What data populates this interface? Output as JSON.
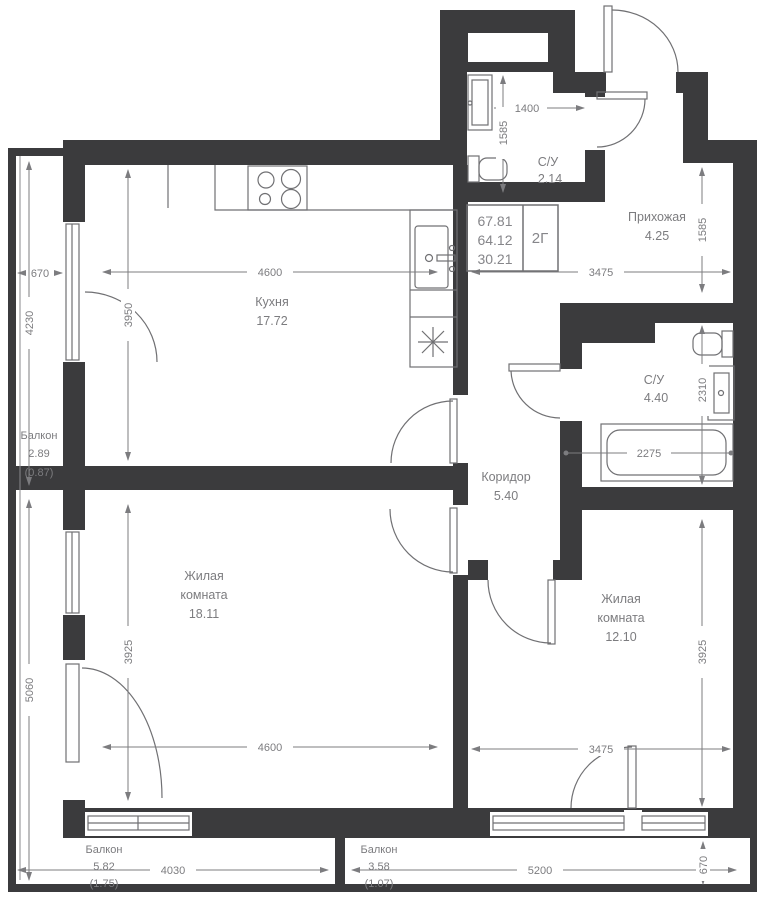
{
  "plan": {
    "rooms": {
      "kitchen": {
        "label": "Кухня",
        "area": "17.72"
      },
      "living_left": {
        "line1": "Жилая",
        "line2": "комната",
        "area": "18.11"
      },
      "living_right": {
        "line1": "Жилая",
        "line2": "комната",
        "area": "12.10"
      },
      "corridor": {
        "label": "Коридор",
        "area": "5.40"
      },
      "hallway": {
        "label": "Прихожая",
        "area": "4.25"
      },
      "wc_small": {
        "label": "С/У",
        "area": "2.14"
      },
      "wc_big": {
        "label": "С/У",
        "area": "4.40"
      },
      "balcony_left": {
        "label": "Балкон",
        "area": "2.89",
        "coeff": "(0.87)"
      },
      "balcony_bottom_left": {
        "label": "Балкон",
        "area": "5.82",
        "coeff": "(1.75)"
      },
      "balcony_bottom_right": {
        "label": "Балкон",
        "area": "3.58",
        "coeff": "(1.07)"
      }
    },
    "stats": {
      "area_total": "67.81",
      "area_living": "64.12",
      "area_rooms": "30.21",
      "layout_code": "2Г"
    },
    "dims": {
      "kitchen_w": "4600",
      "kitchen_h": "3950",
      "living_left_w": "4600",
      "living_left_h": "3925",
      "living_right_w": "3475",
      "living_right_h": "3925",
      "hallway_w": "3475",
      "hallway_h": "1585",
      "wc_small_w": "1400",
      "wc_small_h": "1585",
      "wc_big_h": "2310",
      "bathtub_w": "2275",
      "balcony_left_w": "670",
      "balcony_left_h": "4230",
      "left_lower_h": "5060",
      "balcony_bl_w": "4030",
      "balcony_br_w": "5200",
      "balcony_br_d": "670"
    },
    "colors": {
      "wall": "#3b3b3d",
      "line": "#707073",
      "text": "#7c7c7f"
    }
  }
}
